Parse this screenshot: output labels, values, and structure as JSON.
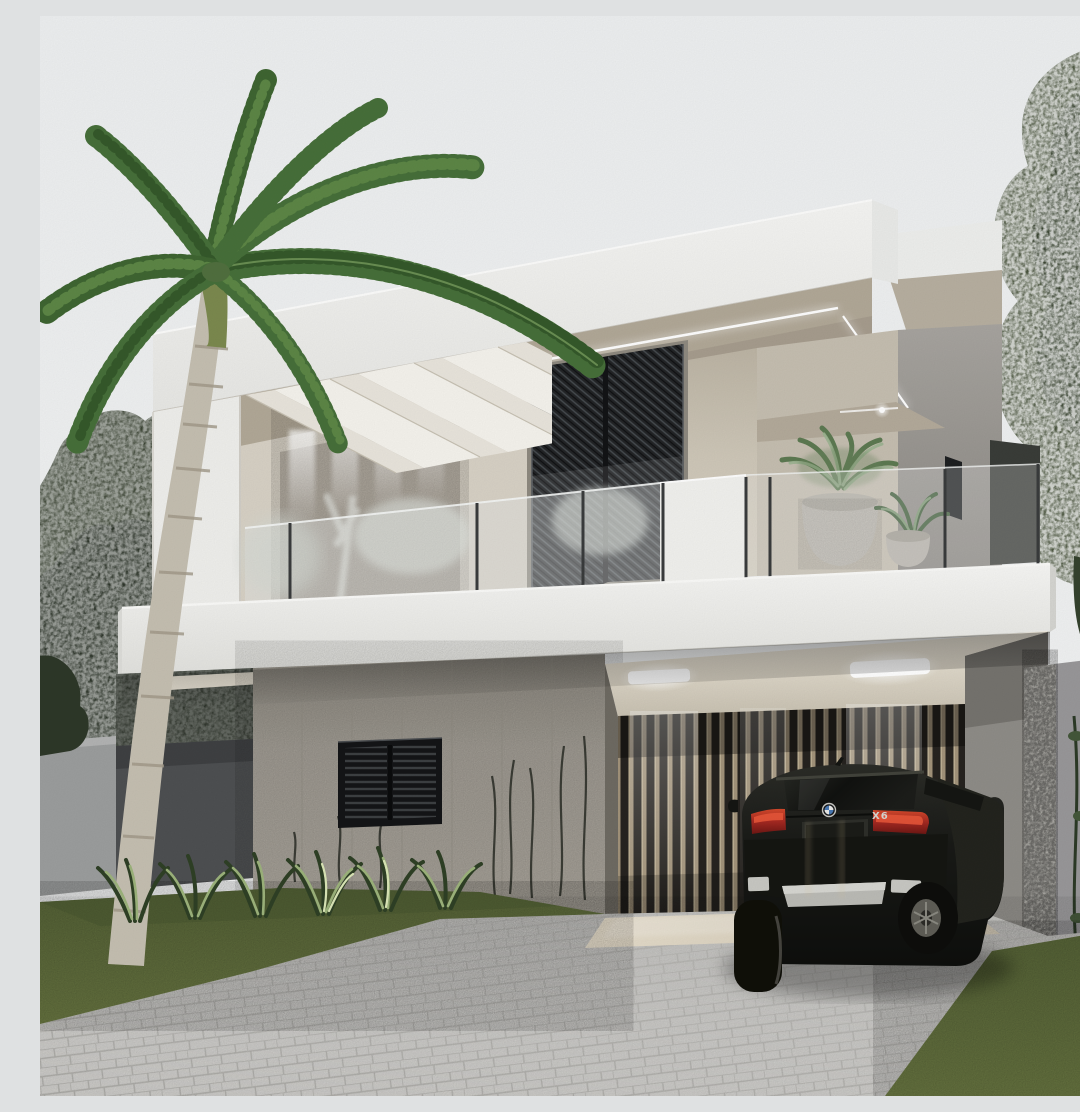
{
  "scene": {
    "title": "Photorealistic render of a modern two-story house with carport, palm tree and parked SUV",
    "palette": {
      "sky": "#eff1f2",
      "band": "#f4f4f2",
      "band_shade": "#e4e4e1",
      "soffit": "#b2a998",
      "greige": "#cfc8b9",
      "greige_dark": "#b4ac9c",
      "wing_gray": "#a09d98",
      "concrete": "#a8a39a",
      "panel_dark": "#4e5052",
      "fence": "#9c9e9e",
      "stone": "#e8e6df",
      "boundary": "#99989a",
      "slat_light": "#a3947b",
      "slat_dark": "#272420",
      "mesh_dark": "#232527",
      "slab": "#f5f5f3",
      "glass_tint": "#e7eceb",
      "grass_hi": "#6e7c45",
      "grass_lo": "#566337",
      "paver_hi": "#d7d6d3",
      "paver_lo": "#c3c2bf",
      "foliage_dark": "#2e362b",
      "foliage_mid": "#42503a",
      "foliage_light": "#9db47c",
      "palm_mid": "#47703a",
      "palm_dark": "#35592b",
      "palm_light": "#6a8f53",
      "trunk": "#c6c0b2",
      "pot": "#c9c5bc",
      "car_body": "#191a17",
      "tail_red": "#a62a22",
      "tail_red_bright": "#e8563a",
      "led": "#ffffff",
      "floor_beige": "#ddd3c1"
    },
    "objects": {
      "palm_tree": "royal palm leaning over facade",
      "house": "white parapet volumes, greige walls, glass balcony",
      "carport": "slatted wall carport with recessed lights",
      "vehicle": "dark SUV parked, rear view",
      "landscape": "paver driveway, lawns, shrub bed, ivy wall"
    }
  },
  "car": {
    "brand_icon": "bmw-roundel",
    "badge_label": "X6"
  }
}
